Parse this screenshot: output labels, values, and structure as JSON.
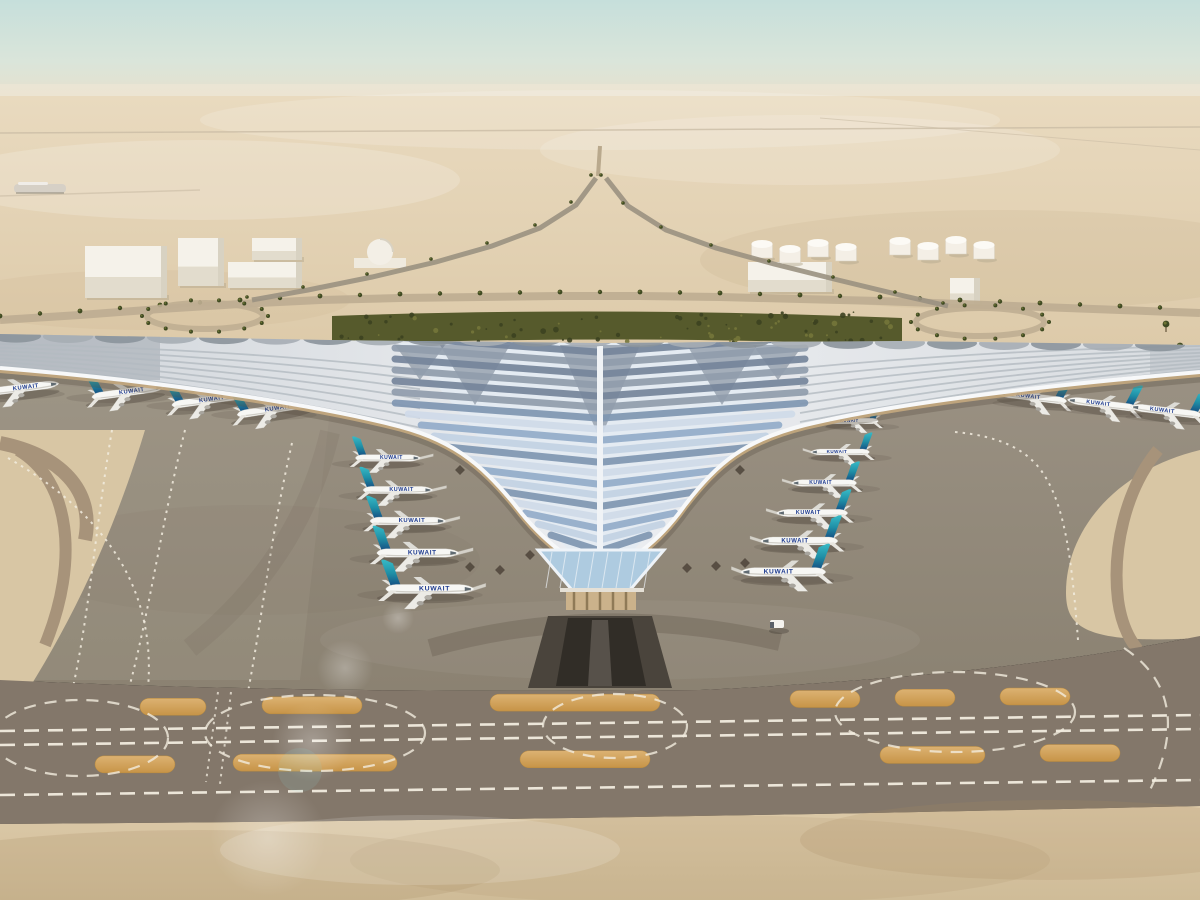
{
  "scene": {
    "title": "Aerial rendering of a desert airport terminal with swooping trefoil canopy and parked Kuwait Airways aircraft",
    "environment": "desert, hazy daylight",
    "sky": {
      "top": "#c6dfdb",
      "mid": "#dae5da",
      "horizon": "#ecdfc8"
    },
    "desert": {
      "far": "#e9dabf",
      "near": "#dcc9a8"
    }
  },
  "terminal": {
    "roof": {
      "base_light": "#eceef1",
      "base_shade": "#cfd4d9",
      "panel_colors": [
        "#93abc9",
        "#c2d1e3",
        "#7f96b1",
        "#cfdae8"
      ],
      "panel_dark_colors": [
        "#75849a",
        "#909cab"
      ],
      "scallop_colors": [
        "#8b939b",
        "#a6adb4"
      ],
      "rib_color": "#b3bac1",
      "fascia_color": "#f7f8f9",
      "underside_color": "#c4a87e",
      "spine_color": "#f0f3f6",
      "fan_color": "#6f7c8c",
      "diamond_color": "#4d443a"
    },
    "tip": {
      "glass": "#aecbe0",
      "mullion": "#eef3f8",
      "base": "#cbb28b",
      "column": "#8f7a57"
    },
    "tunnel": {
      "outer": "#4a443c",
      "inner": "#312d27"
    }
  },
  "aircraft": {
    "livery_label": "KUWAIT",
    "fuselage_color": "#f7f7f4",
    "tail_teal_top": "#38bac6",
    "tail_teal_mid": "#1f8fa6",
    "tail_blue_base": "#15497f",
    "text_color": "#1e3b8f",
    "left_column": [
      {
        "x": 388,
        "y": 458,
        "s": 0.42,
        "b": 38
      },
      {
        "x": 398,
        "y": 490,
        "s": 0.45,
        "b": 38
      },
      {
        "x": 408,
        "y": 521,
        "s": 0.49,
        "b": 36
      },
      {
        "x": 418,
        "y": 553,
        "s": 0.53,
        "b": 34
      },
      {
        "x": 430,
        "y": 589,
        "s": 0.57,
        "b": 28
      }
    ],
    "right_column": [
      {
        "x": 852,
        "y": 421,
        "s": 0.34,
        "b": 26
      },
      {
        "x": 840,
        "y": 452,
        "s": 0.38,
        "b": 28
      },
      {
        "x": 824,
        "y": 483,
        "s": 0.42,
        "b": 30
      },
      {
        "x": 812,
        "y": 513,
        "s": 0.46,
        "b": 30
      },
      {
        "x": 799,
        "y": 541,
        "s": 0.5,
        "b": 28
      },
      {
        "x": 783,
        "y": 572,
        "s": 0.55,
        "b": 24
      }
    ],
    "left_wing_row": [
      {
        "x": 22,
        "y": 388,
        "s": 0.48,
        "r": -7
      },
      {
        "x": 128,
        "y": 392,
        "s": 0.47,
        "r": -8
      },
      {
        "x": 208,
        "y": 400,
        "s": 0.47,
        "r": -8
      },
      {
        "x": 274,
        "y": 409,
        "s": 0.48,
        "r": -9
      }
    ],
    "right_wing_row": [
      {
        "x": 1032,
        "y": 397,
        "s": 0.45,
        "r": 7
      },
      {
        "x": 1102,
        "y": 404,
        "s": 0.45,
        "r": 7
      },
      {
        "x": 1166,
        "y": 411,
        "s": 0.46,
        "r": 7
      }
    ]
  },
  "background": {
    "warehouses": [
      {
        "x": 85,
        "y": 246,
        "w": 82,
        "h": 52
      },
      {
        "x": 178,
        "y": 238,
        "w": 46,
        "h": 48
      },
      {
        "x": 228,
        "y": 262,
        "w": 74,
        "h": 26
      },
      {
        "x": 252,
        "y": 238,
        "w": 50,
        "h": 22
      },
      {
        "x": 748,
        "y": 262,
        "w": 84,
        "h": 30
      },
      {
        "x": 950,
        "y": 278,
        "w": 30,
        "h": 26
      }
    ],
    "dome": {
      "cx": 380,
      "cy": 252,
      "r": 13
    },
    "tanks": [
      {
        "cx": 762,
        "cy": 250
      },
      {
        "cx": 790,
        "cy": 255
      },
      {
        "cx": 818,
        "cy": 249
      },
      {
        "cx": 846,
        "cy": 253
      },
      {
        "cx": 900,
        "cy": 247
      },
      {
        "cx": 928,
        "cy": 252
      },
      {
        "cx": 956,
        "cy": 246
      },
      {
        "cx": 984,
        "cy": 251
      }
    ],
    "left_blob": {
      "x": 14,
      "y": 184,
      "w": 52,
      "h": 9
    },
    "loops": [
      {
        "cx": 205,
        "cy": 316,
        "rx": 58,
        "ry": 13
      },
      {
        "cx": 980,
        "cy": 322,
        "rx": 64,
        "ry": 14
      }
    ],
    "branch_left": [
      [
        596,
        178
      ],
      [
        576,
        205
      ],
      [
        540,
        228
      ],
      [
        492,
        246
      ],
      [
        436,
        262
      ],
      [
        372,
        277
      ],
      [
        308,
        290
      ],
      [
        252,
        300
      ]
    ],
    "branch_right": [
      [
        606,
        178
      ],
      [
        628,
        206
      ],
      [
        666,
        230
      ],
      [
        716,
        248
      ],
      [
        774,
        264
      ],
      [
        838,
        280
      ],
      [
        900,
        295
      ],
      [
        948,
        306
      ]
    ],
    "road_points": [
      [
        0,
        320
      ],
      [
        80,
        315
      ],
      [
        160,
        309
      ],
      [
        240,
        304
      ],
      [
        320,
        300
      ],
      [
        400,
        298
      ],
      [
        480,
        297
      ],
      [
        560,
        296
      ],
      [
        640,
        296
      ],
      [
        720,
        297
      ],
      [
        800,
        299
      ],
      [
        880,
        301
      ],
      [
        960,
        304
      ],
      [
        1040,
        307
      ],
      [
        1120,
        310
      ],
      [
        1200,
        313
      ]
    ],
    "right_palms": [
      [
        1166,
        324
      ],
      [
        1180,
        346
      ],
      [
        1192,
        370
      ],
      [
        1186,
        398
      ],
      [
        1196,
        420
      ]
    ],
    "grove": {
      "fill": "#565a2c",
      "speckle_dark": "#3c4120",
      "speckle_light": "#74763a"
    },
    "road_color": "#bfae92",
    "palm_color": "#3f4a22",
    "palm_highlight": "#6d7434"
  },
  "ground": {
    "apron_top": "#9a9183",
    "apron_bottom": "#8b8272",
    "apron_left_light": "#a79d8d",
    "taxiway": "#83776a",
    "corner_wedge_fill": "#d8c6a4",
    "corner_wedge_lane": "#a7937a",
    "island_fill_top": "#dcb272",
    "island_fill_bottom": "#c79447",
    "dash_color": "#f2ecdf",
    "islands_row1": [
      [
        140,
        66
      ],
      [
        262,
        100
      ],
      [
        490,
        170
      ],
      [
        790,
        70
      ],
      [
        895,
        60
      ],
      [
        1000,
        70
      ]
    ],
    "islands_row2": [
      [
        95,
        80
      ],
      [
        233,
        164
      ],
      [
        520,
        130
      ],
      [
        880,
        105
      ],
      [
        1040,
        80
      ]
    ],
    "dash_lines": [
      [
        0,
        731,
        1200,
        715
      ],
      [
        0,
        745,
        1200,
        729
      ],
      [
        0,
        795,
        1200,
        780
      ]
    ],
    "connector_ellipses": [
      [
        80,
        738,
        88,
        38
      ],
      [
        315,
        733,
        110,
        38
      ],
      [
        615,
        726,
        72,
        32
      ],
      [
        955,
        712,
        120,
        40
      ]
    ],
    "foreground_top": "#dcc9a8",
    "foreground_bottom": "#cfbc98",
    "stand_lane": "#5f574a"
  },
  "vehicles": {
    "service_truck": {
      "x": 770,
      "y": 620,
      "color": "#f4f2ee"
    }
  },
  "effects": {
    "lens_flare": [
      [
        345,
        668,
        28
      ],
      [
        312,
        742,
        40
      ],
      [
        268,
        838,
        58
      ],
      [
        398,
        618,
        16
      ]
    ],
    "flare_teal": {
      "x": 300,
      "y": 770,
      "r": 22,
      "color": "#8fd8d8"
    }
  }
}
